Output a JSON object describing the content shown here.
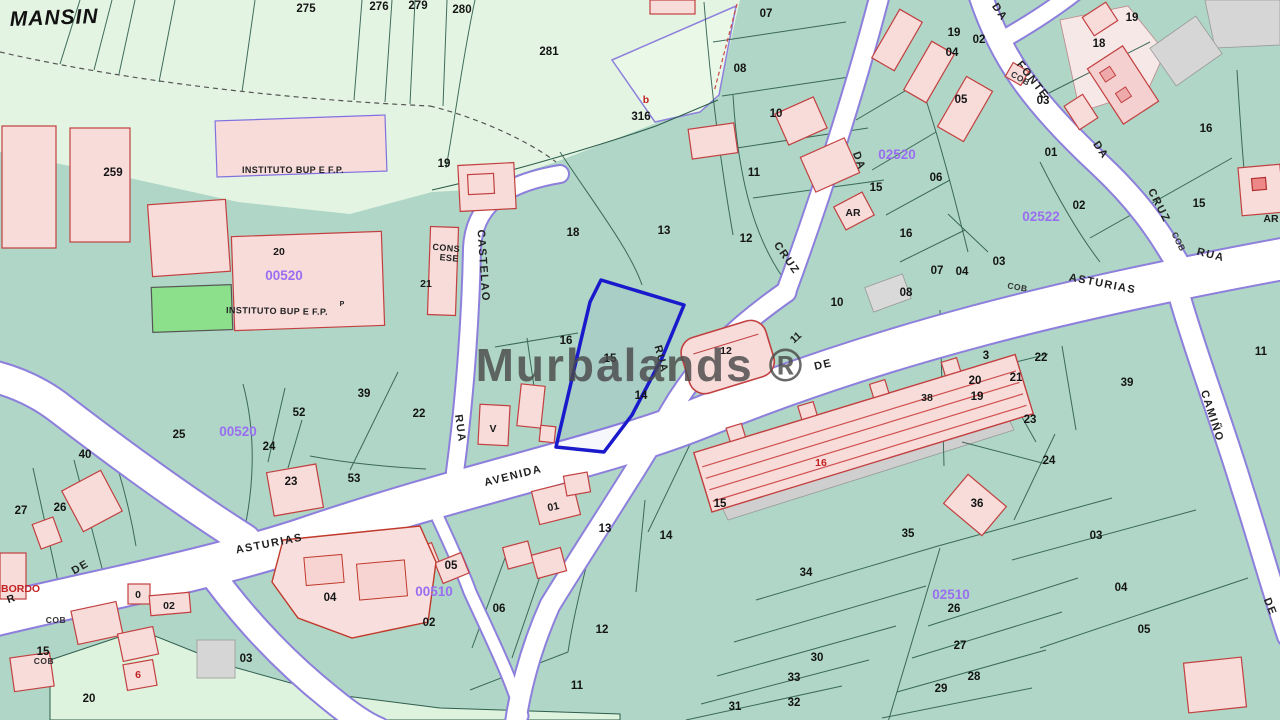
{
  "map": {
    "watermark": "Murbalands ®",
    "colors": {
      "parcel_teal": "#afd6c6",
      "field_pale_green": "#e3f5e2",
      "road_white": "#ffffff",
      "road_border_purple": "#8d7fdc",
      "building_pink": "#f7dcda",
      "building_stroke_red": "#c24040",
      "green_building": "#8ce08c",
      "gray_parcel": "#d6d6d6",
      "highlight_blue": "#1a1acc",
      "zone_code_purple": "#9a6ef0",
      "red_label": "#c22222",
      "boundary_green": "#2f5d4d",
      "watermark_gray": "#4a4a4a"
    },
    "highlighted_parcel": {
      "label": "15",
      "border_color": "#1a1acc"
    },
    "place_labels": [
      {
        "t": "MANSIN",
        "x": 10,
        "y": 26,
        "r": -2,
        "c": "big",
        "a": "s"
      },
      {
        "t": "INSTITUTO BUP E F.P.",
        "x": 293,
        "y": 173,
        "r": 0,
        "c": "inst"
      },
      {
        "t": "INSTITUTO BUP E F.P.",
        "x": 277,
        "y": 314,
        "r": 1,
        "c": "inst"
      },
      {
        "t": "P",
        "x": 342,
        "y": 306,
        "r": 0,
        "c": "instp"
      },
      {
        "t": "CONS",
        "x": 446,
        "y": 251,
        "r": 5,
        "c": "inst"
      },
      {
        "t": "ESE",
        "x": 449,
        "y": 261,
        "r": 5,
        "c": "inst"
      }
    ],
    "street_labels": [
      {
        "t": "DA",
        "x": 997,
        "y": 14,
        "r": 55,
        "c": "st"
      },
      {
        "t": "FONTE",
        "x": 1030,
        "y": 82,
        "r": 52,
        "c": "st"
      },
      {
        "t": "DA",
        "x": 1098,
        "y": 152,
        "r": 56,
        "c": "st"
      },
      {
        "t": "CRUZ",
        "x": 1156,
        "y": 207,
        "r": 63,
        "c": "st"
      },
      {
        "t": "COB",
        "x": 1176,
        "y": 243,
        "r": 63,
        "c": "sts"
      },
      {
        "t": "RUA",
        "x": 1210,
        "y": 258,
        "r": 14,
        "c": "st"
      },
      {
        "t": "ASTURIAS",
        "x": 1102,
        "y": 287,
        "r": 11,
        "c": "st"
      },
      {
        "t": "DA",
        "x": 856,
        "y": 162,
        "r": 70,
        "c": "st"
      },
      {
        "t": "CRUZ",
        "x": 784,
        "y": 260,
        "r": 55,
        "c": "st"
      },
      {
        "t": "RUA",
        "x": 658,
        "y": 360,
        "r": 75,
        "c": "st"
      },
      {
        "t": "DE",
        "x": 824,
        "y": 368,
        "r": -13,
        "c": "st"
      },
      {
        "t": "AVENIDA",
        "x": 514,
        "y": 479,
        "r": -14,
        "c": "st"
      },
      {
        "t": "ASTURIAS",
        "x": 270,
        "y": 547,
        "r": -11,
        "c": "st"
      },
      {
        "t": "DE",
        "x": 82,
        "y": 570,
        "r": -30,
        "c": "st"
      },
      {
        "t": "CASTELAO",
        "x": 480,
        "y": 266,
        "r": 86,
        "c": "st"
      },
      {
        "t": "RUA",
        "x": 457,
        "y": 429,
        "r": 82,
        "c": "st"
      },
      {
        "t": "CAMIÑO",
        "x": 1209,
        "y": 417,
        "r": 72,
        "c": "st"
      },
      {
        "t": "DE",
        "x": 1267,
        "y": 608,
        "r": 68,
        "c": "st"
      },
      {
        "t": "COB",
        "x": 1017,
        "y": 290,
        "r": 10,
        "c": "sts"
      },
      {
        "t": "COB",
        "x": 1019,
        "y": 81,
        "r": 30,
        "c": "sts"
      },
      {
        "t": "COB",
        "x": 56,
        "y": 623,
        "r": 0,
        "c": "sts"
      },
      {
        "t": "COB",
        "x": 44,
        "y": 664,
        "r": 0,
        "c": "sts"
      }
    ],
    "zone_codes": [
      {
        "t": "00520",
        "x": 284,
        "y": 280
      },
      {
        "t": "00520",
        "x": 238,
        "y": 436
      },
      {
        "t": "02520",
        "x": 897,
        "y": 159
      },
      {
        "t": "02522",
        "x": 1041,
        "y": 221
      },
      {
        "t": "00510",
        "x": 434,
        "y": 596
      },
      {
        "t": "02510",
        "x": 951,
        "y": 599
      }
    ],
    "parcel_numbers": [
      {
        "t": "275",
        "x": 306,
        "y": 12
      },
      {
        "t": "276",
        "x": 379,
        "y": 10
      },
      {
        "t": "279",
        "x": 418,
        "y": 9
      },
      {
        "t": "280",
        "x": 462,
        "y": 13
      },
      {
        "t": "281",
        "x": 549,
        "y": 55
      },
      {
        "t": "316",
        "x": 641,
        "y": 120
      },
      {
        "t": "259",
        "x": 113,
        "y": 176
      },
      {
        "t": "19",
        "x": 444,
        "y": 167
      },
      {
        "t": "18",
        "x": 573,
        "y": 236
      },
      {
        "t": "13",
        "x": 664,
        "y": 234
      },
      {
        "t": "12",
        "x": 746,
        "y": 242
      },
      {
        "t": "07",
        "x": 766,
        "y": 17
      },
      {
        "t": "08",
        "x": 740,
        "y": 72
      },
      {
        "t": "10",
        "x": 776,
        "y": 117
      },
      {
        "t": "11",
        "x": 754,
        "y": 176
      },
      {
        "t": "10",
        "x": 837,
        "y": 306
      },
      {
        "t": "16",
        "x": 566,
        "y": 344
      },
      {
        "t": "15",
        "x": 610,
        "y": 362
      },
      {
        "t": "14",
        "x": 641,
        "y": 399
      },
      {
        "t": "14",
        "x": 666,
        "y": 539
      },
      {
        "t": "13",
        "x": 605,
        "y": 532
      },
      {
        "t": "15",
        "x": 720,
        "y": 507
      },
      {
        "t": "12",
        "x": 602,
        "y": 633
      },
      {
        "t": "11",
        "x": 577,
        "y": 689
      },
      {
        "t": "06",
        "x": 499,
        "y": 612
      },
      {
        "t": "02",
        "x": 429,
        "y": 626
      },
      {
        "t": "05",
        "x": 451,
        "y": 569
      },
      {
        "t": "04",
        "x": 330,
        "y": 601
      },
      {
        "t": "22",
        "x": 419,
        "y": 417
      },
      {
        "t": "39",
        "x": 364,
        "y": 397
      },
      {
        "t": "52",
        "x": 299,
        "y": 416
      },
      {
        "t": "53",
        "x": 354,
        "y": 482
      },
      {
        "t": "23",
        "x": 291,
        "y": 485
      },
      {
        "t": "24",
        "x": 269,
        "y": 450
      },
      {
        "t": "25",
        "x": 179,
        "y": 438
      },
      {
        "t": "40",
        "x": 85,
        "y": 458
      },
      {
        "t": "26",
        "x": 60,
        "y": 511
      },
      {
        "t": "27",
        "x": 21,
        "y": 514
      },
      {
        "t": "03",
        "x": 246,
        "y": 662
      },
      {
        "t": "20",
        "x": 89,
        "y": 702
      },
      {
        "t": "15",
        "x": 43,
        "y": 655
      },
      {
        "t": "19",
        "x": 954,
        "y": 36
      },
      {
        "t": "02",
        "x": 979,
        "y": 43
      },
      {
        "t": "04",
        "x": 952,
        "y": 56
      },
      {
        "t": "05",
        "x": 961,
        "y": 103
      },
      {
        "t": "03",
        "x": 1043,
        "y": 104
      },
      {
        "t": "01",
        "x": 1051,
        "y": 156
      },
      {
        "t": "06",
        "x": 936,
        "y": 181
      },
      {
        "t": "15",
        "x": 876,
        "y": 191
      },
      {
        "t": "16",
        "x": 906,
        "y": 237
      },
      {
        "t": "02",
        "x": 1079,
        "y": 209
      },
      {
        "t": "03",
        "x": 999,
        "y": 265
      },
      {
        "t": "07",
        "x": 937,
        "y": 274
      },
      {
        "t": "04",
        "x": 962,
        "y": 275
      },
      {
        "t": "08",
        "x": 906,
        "y": 296
      },
      {
        "t": "19",
        "x": 1132,
        "y": 21
      },
      {
        "t": "18",
        "x": 1099,
        "y": 47
      },
      {
        "t": "16",
        "x": 1206,
        "y": 132
      },
      {
        "t": "15",
        "x": 1199,
        "y": 207
      },
      {
        "t": "11",
        "x": 1261,
        "y": 355
      },
      {
        "t": "3",
        "x": 986,
        "y": 359
      },
      {
        "t": "20",
        "x": 975,
        "y": 384
      },
      {
        "t": "21",
        "x": 1016,
        "y": 381
      },
      {
        "t": "19",
        "x": 977,
        "y": 400
      },
      {
        "t": "22",
        "x": 1041,
        "y": 361
      },
      {
        "t": "23",
        "x": 1030,
        "y": 423
      },
      {
        "t": "24",
        "x": 1049,
        "y": 464
      },
      {
        "t": "39",
        "x": 1127,
        "y": 386
      },
      {
        "t": "36",
        "x": 977,
        "y": 507
      },
      {
        "t": "03",
        "x": 1096,
        "y": 539
      },
      {
        "t": "35",
        "x": 908,
        "y": 537
      },
      {
        "t": "34",
        "x": 806,
        "y": 576
      },
      {
        "t": "26",
        "x": 954,
        "y": 612
      },
      {
        "t": "27",
        "x": 960,
        "y": 649
      },
      {
        "t": "28",
        "x": 974,
        "y": 680
      },
      {
        "t": "29",
        "x": 941,
        "y": 692
      },
      {
        "t": "30",
        "x": 817,
        "y": 661
      },
      {
        "t": "33",
        "x": 794,
        "y": 681
      },
      {
        "t": "32",
        "x": 794,
        "y": 706
      },
      {
        "t": "31",
        "x": 735,
        "y": 710
      },
      {
        "t": "04",
        "x": 1121,
        "y": 591
      },
      {
        "t": "05",
        "x": 1144,
        "y": 633
      }
    ],
    "building_labels": [
      {
        "t": "AR",
        "x": 853,
        "y": 216,
        "c": "nb"
      },
      {
        "t": "AR",
        "x": 1271,
        "y": 222,
        "c": "nb"
      },
      {
        "t": "V",
        "x": 493,
        "y": 432,
        "c": "nb"
      },
      {
        "t": "01",
        "x": 554,
        "y": 510,
        "c": "nb",
        "r": -12
      },
      {
        "t": "38",
        "x": 927,
        "y": 401,
        "c": "nb"
      },
      {
        "t": "12",
        "x": 726,
        "y": 354,
        "c": "nb"
      },
      {
        "t": "11",
        "x": 798,
        "y": 340,
        "c": "nb",
        "r": -42
      },
      {
        "t": "0",
        "x": 138,
        "y": 598,
        "c": "nb"
      },
      {
        "t": "02",
        "x": 169,
        "y": 609,
        "c": "nb"
      },
      {
        "t": "20",
        "x": 279,
        "y": 255,
        "c": "nb"
      },
      {
        "t": "21",
        "x": 426,
        "y": 287,
        "c": "nb"
      },
      {
        "t": "R",
        "x": 12,
        "y": 602,
        "c": "nb",
        "r": -20
      }
    ],
    "red_labels": [
      {
        "t": "b",
        "x": 646,
        "y": 103
      },
      {
        "t": "6",
        "x": 138,
        "y": 678
      },
      {
        "t": "16",
        "x": 821,
        "y": 466
      },
      {
        "t": "EBORDO",
        "x": -6,
        "y": 592,
        "a": "s"
      }
    ]
  }
}
